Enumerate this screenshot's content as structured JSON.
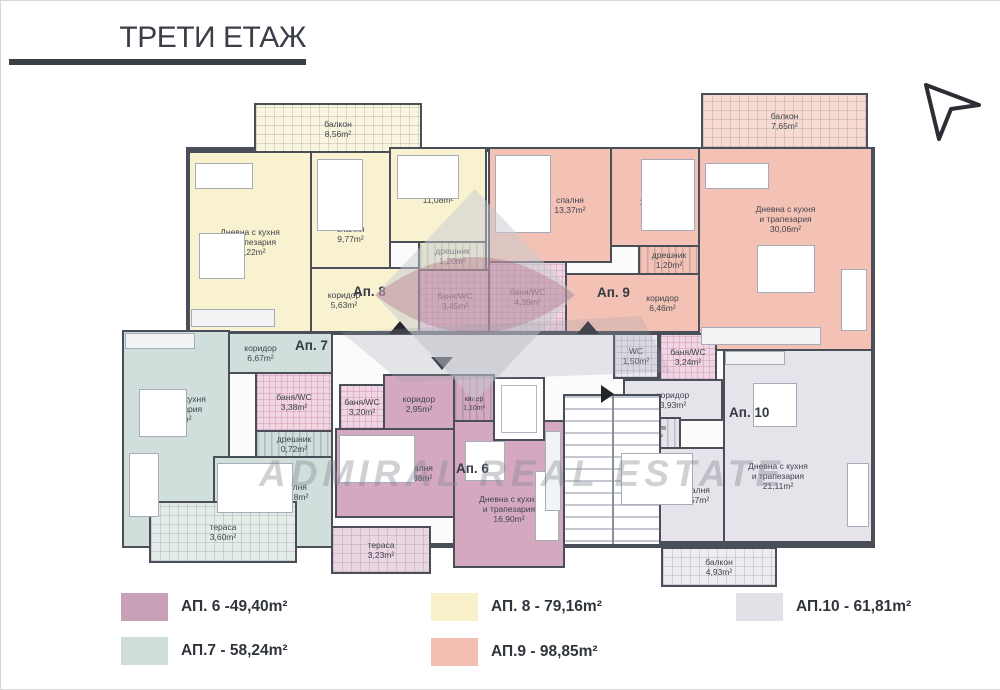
{
  "page": {
    "title": "ТРЕТИ ЕТАЖ"
  },
  "colors": {
    "wall": "#4a4e59",
    "ap6": "#d4a9bf",
    "ap7": "#d0dfdb",
    "ap8": "#f8f2d0",
    "ap9": "#f4c2b5",
    "ap10": "#e7e3ea",
    "ap8_balc": "#f9f5de",
    "ap9_balc": "#f7dbd2",
    "ap7_terr": "#e3ece9",
    "ap6_terr": "#ead6e2",
    "ap10_balc": "#efecf1",
    "bath_tile": "#f0d6e2",
    "wc_tile": "#eceaf0"
  },
  "watermark": {
    "text": "ADMIRAL REAL ESTATE"
  },
  "plan": {
    "apartments": [
      {
        "id": "ap6",
        "label": "Ап. 6"
      },
      {
        "id": "ap7",
        "label": "Ап. 7"
      },
      {
        "id": "ap8",
        "label": "Ап. 8"
      },
      {
        "id": "ap9",
        "label": "Ап. 9"
      },
      {
        "id": "ap10",
        "label": "Ап. 10"
      }
    ],
    "rooms": {
      "ap8_balcony": {
        "name": "балкон",
        "area": "8,56m²"
      },
      "ap8_living": {
        "name": "Дневна с кухня\nи трапезария",
        "area": "19,22m²"
      },
      "ap8_bed1": {
        "name": "спалня",
        "area": "9,77m²"
      },
      "ap8_bed2": {
        "name": "спалня",
        "area": "11,08m²"
      },
      "ap8_closet": {
        "name": "дрешник",
        "area": "1,20m²"
      },
      "ap8_corridor": {
        "name": "коридор",
        "area": "5,63m²"
      },
      "ap8_bath": {
        "name": "баня/WC",
        "area": "3,45m²"
      },
      "ap9_bed1": {
        "name": "спалня",
        "area": "13,37m²"
      },
      "ap9_bed2": {
        "name": "спалня",
        "area": "13,31m²"
      },
      "ap9_bath": {
        "name": "баня/WC",
        "area": "4,39m²"
      },
      "ap9_closet": {
        "name": "дрешник",
        "area": "1,20m²"
      },
      "ap9_corridor": {
        "name": "коридор",
        "area": "6,46m²"
      },
      "ap9_living": {
        "name": "Дневна с кухня\nи трапезария",
        "area": "30,06m²"
      },
      "ap9_balcony": {
        "name": "балкон",
        "area": "7,65m²"
      },
      "ap9_wc": {
        "name": "WC",
        "area": "1,50m²"
      },
      "ap7_corridor": {
        "name": "коридор",
        "area": "6,67m²"
      },
      "ap7_living": {
        "name": "Дневна с кухня\nи трапезария",
        "area": "18,10m²"
      },
      "ap7_bath": {
        "name": "баня/WC",
        "area": "3,38m²"
      },
      "ap7_closet": {
        "name": "дрешник",
        "area": "0,72m²"
      },
      "ap7_bed": {
        "name": "спалня",
        "area": "11,28m²"
      },
      "ap7_terrace": {
        "name": "тераса",
        "area": "3,60m²"
      },
      "ap6_bath": {
        "name": "баня/WC",
        "area": "3,20m²"
      },
      "ap6_corridor": {
        "name": "коридор",
        "area": "2,95m²"
      },
      "ap6_storage": {
        "name": "килер",
        "area": "1,10m²"
      },
      "ap6_bed": {
        "name": "спалня",
        "area": "9,38m²"
      },
      "ap6_living": {
        "name": "Дневна с кухня\nи трапезария",
        "area": "16,90m²"
      },
      "ap6_terrace": {
        "name": "тераса",
        "area": "3,23m²"
      },
      "ap10_bath": {
        "name": "баня/WC",
        "area": "3,24m²"
      },
      "ap10_corridor": {
        "name": "коридор",
        "area": "3,93m²"
      },
      "ap10_closet": {
        "name": "дрешник",
        "area": "1,20m²"
      },
      "ap10_bed": {
        "name": "спалня",
        "area": "9,57m²"
      },
      "ap10_living": {
        "name": "Дневна с кухня\nи трапезария",
        "area": "21,11m²"
      },
      "ap10_balcony": {
        "name": "балкон",
        "area": "4,93m²"
      }
    }
  },
  "legend": {
    "items": [
      {
        "label": "АП. 6 -49,40m²",
        "color": "#c9a0b6"
      },
      {
        "label": "АП.7 - 58,24m²",
        "color": "#cfdeda"
      },
      {
        "label": "АП. 8 - 79,16m²",
        "color": "#f8f0c9"
      },
      {
        "label": "АП.9 - 98,85m²",
        "color": "#f2bfb2"
      },
      {
        "label": "АП.10 - 61,81m²",
        "color": "#e4e0e8"
      }
    ]
  }
}
